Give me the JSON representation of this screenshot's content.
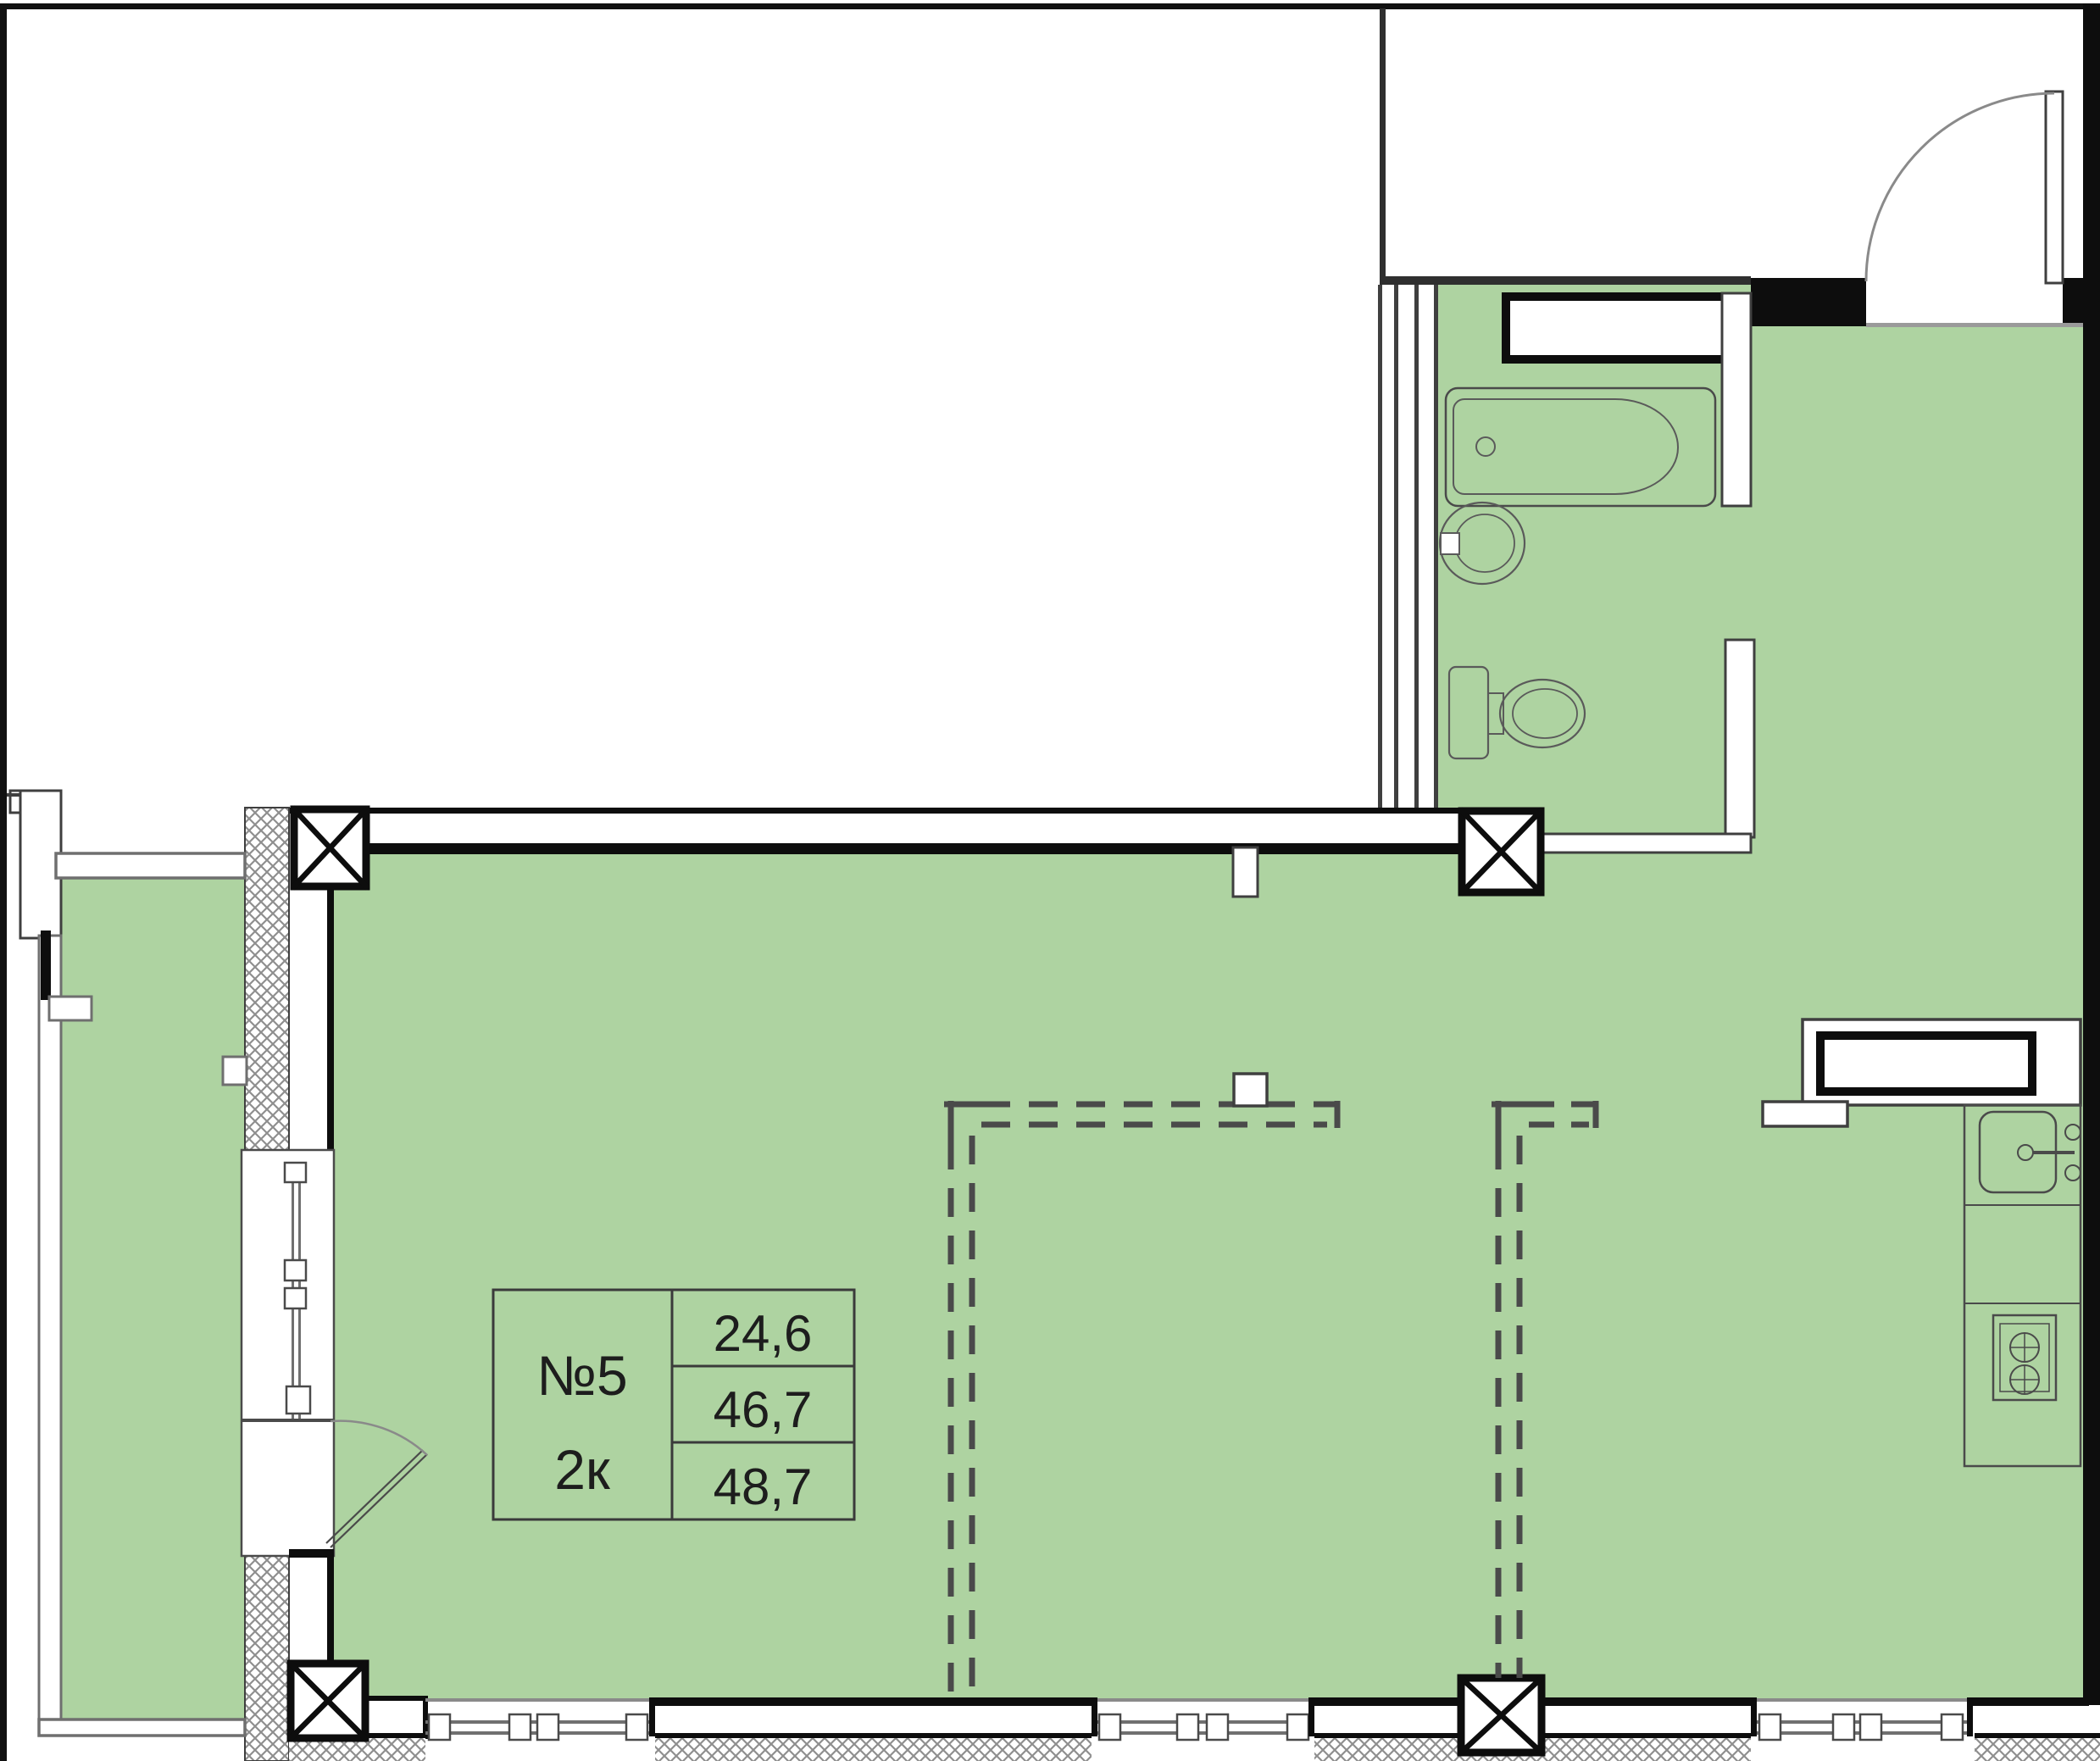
{
  "title": "Apartment floor plan",
  "unit": {
    "number": "№5",
    "type": "2к",
    "areas": [
      "24,6",
      "46,7",
      "48,7"
    ]
  },
  "colors": {
    "room_fill": "#aed3a1",
    "wall_black": "#0d0d0d",
    "thin_outline": "#3f3f3f",
    "rail_gray": "#6f6f6f",
    "arc_gray": "#8a8a8a",
    "hatch_gray": "#8f8f8f",
    "text": "#1d1d1d",
    "table_border": "#3a3a3a"
  },
  "fixtures": [
    "bathtub",
    "bathroom-sink",
    "toilet",
    "ventilation-shaft-bathroom",
    "ventilation-shaft-kitchen",
    "kitchen-sink",
    "stove",
    "kitchen-counter",
    "entrance-door",
    "balcony-door",
    "balcony-window",
    "windows",
    "columns",
    "dashed-partitions",
    "balcony-railing"
  ]
}
